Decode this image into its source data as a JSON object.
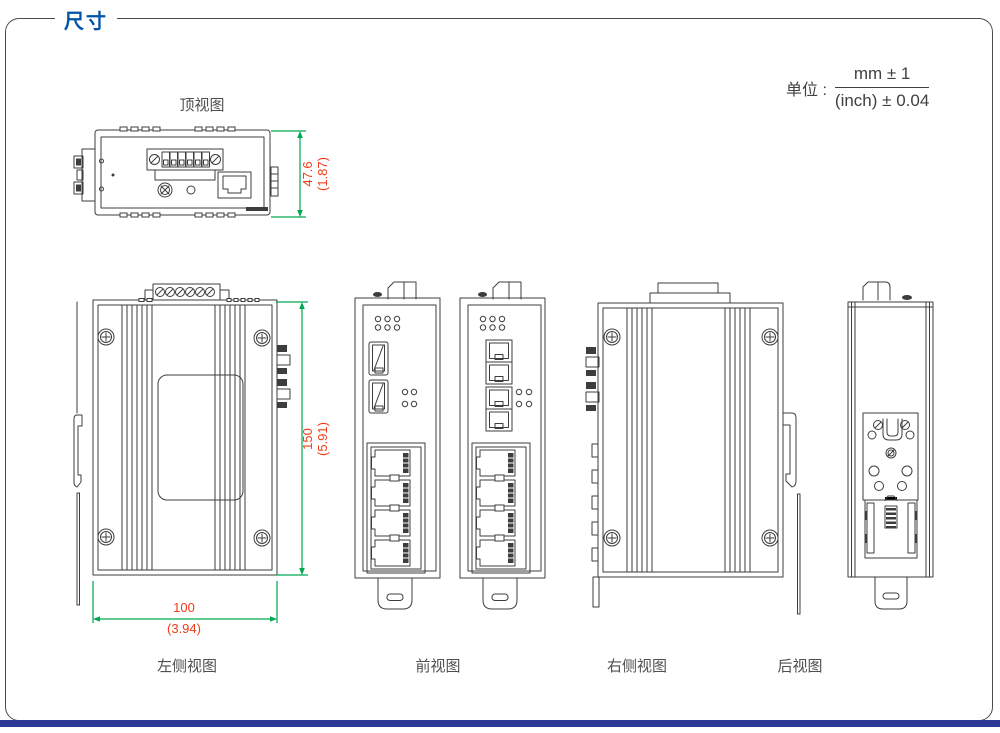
{
  "page": {
    "title": "尺寸"
  },
  "units": {
    "label": "单位 :",
    "numerator": "mm ± 1",
    "denominator": "(inch) ± 0.04"
  },
  "views": {
    "top": {
      "label": "顶视图"
    },
    "left": {
      "label": "左侧视图"
    },
    "front": {
      "label": "前视图"
    },
    "right": {
      "label": "右侧视图"
    },
    "rear": {
      "label": "后视图"
    }
  },
  "dimensions": {
    "depth": {
      "mm": "47.6",
      "inch": "(1.87)"
    },
    "height": {
      "mm": "150",
      "inch": "(5.91)"
    },
    "width": {
      "mm": "100",
      "inch": "(3.94)"
    }
  },
  "colors": {
    "accent": "#0054a6",
    "dim-line": "#00a651",
    "dim-text": "#f43b19",
    "line": "#3d3d3f",
    "label-text": "#4f4f51",
    "footer-bar": "#2d3a96",
    "frame-border": "#4c4c4e"
  }
}
